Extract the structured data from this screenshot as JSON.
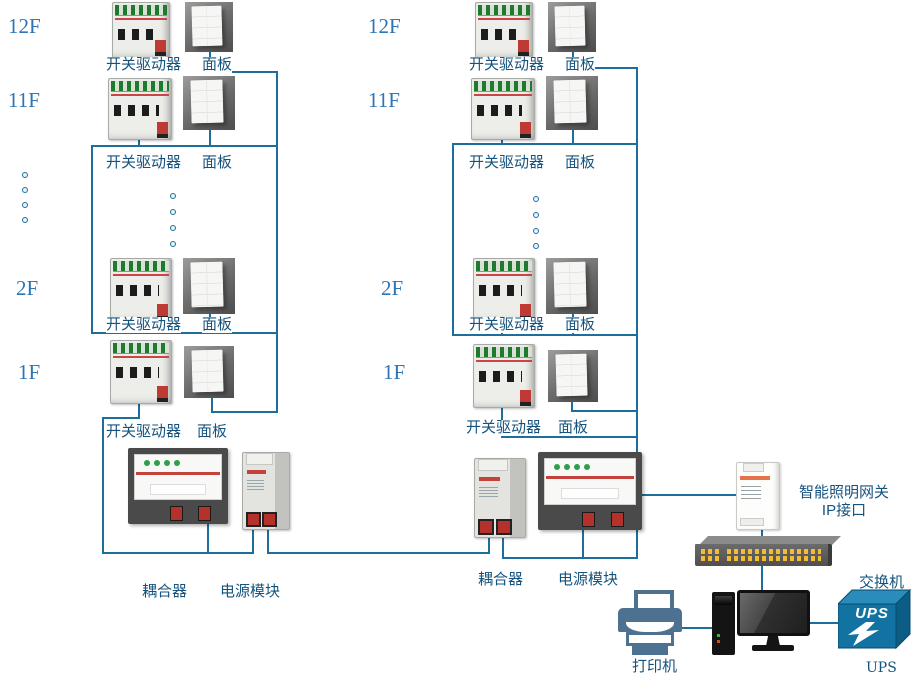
{
  "floors": {
    "f12": "12F",
    "f11": "11F",
    "f2": "2F",
    "f1": "1F"
  },
  "labels": {
    "switch_driver": "开关驱动器",
    "panel": "面板",
    "coupler": "耦合器",
    "power_module": "电源模块",
    "gateway_line1": "智能照明网关",
    "gateway_line2": "IP接口",
    "network_switch": "交换机",
    "printer": "打印机",
    "ups_box": "UPS",
    "ups": "UPS"
  },
  "colors": {
    "line": "#1e6e9c",
    "label_text": "#15537d",
    "floor_text": "#2e75b6",
    "ups_blue": "#1272a2",
    "printer_blue": "#4d7191",
    "port_yellow": "#f2bc35",
    "terminal_green": "#1e7a2e",
    "stripe_red": "#c4423a"
  }
}
